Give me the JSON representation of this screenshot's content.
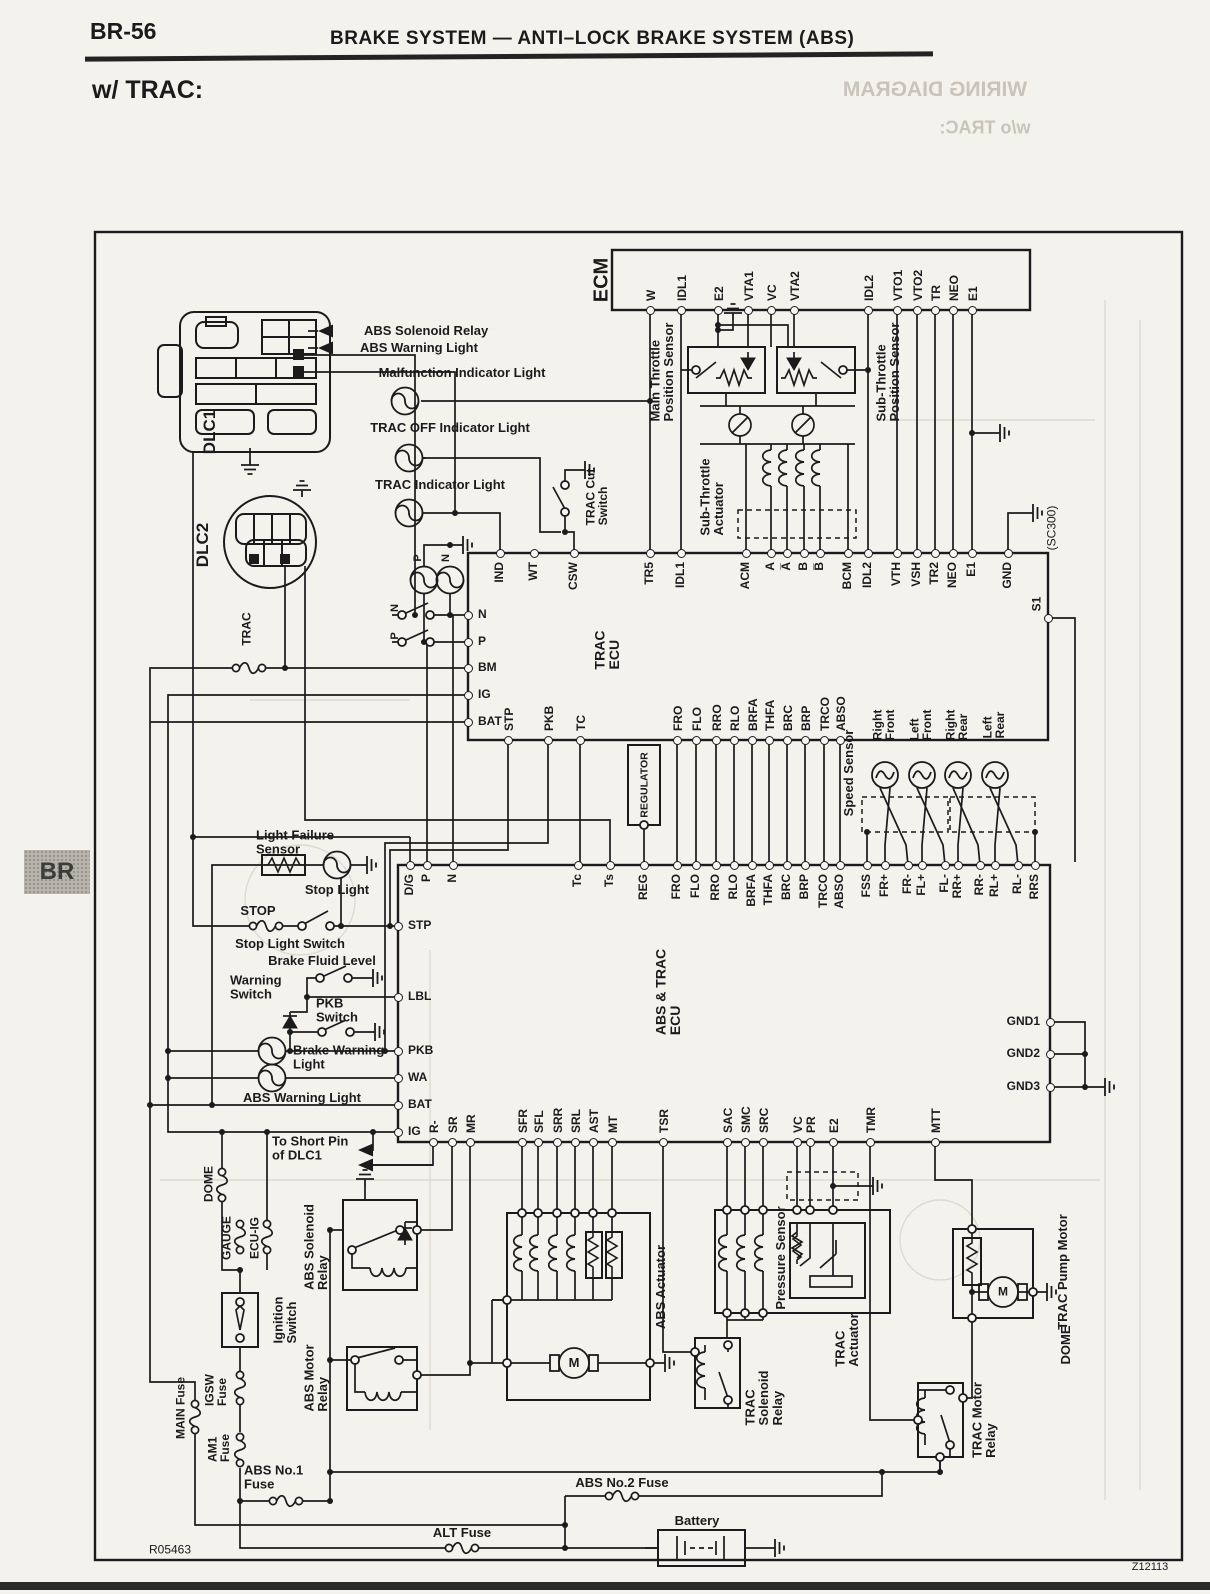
{
  "page": {
    "code": "BR-56",
    "title": "BRAKE SYSTEM — ANTI–LOCK BRAKE SYSTEM (ABS)",
    "subtitle": "w/ TRAC:",
    "side_tab": "BR",
    "doc_number": "R05463",
    "figure_number": "Z12113"
  },
  "ghost_text": [
    {
      "id": "ghost-wiring-diagram",
      "text": "WIRING DIAGRAM",
      "x": 935,
      "y": 90,
      "size": 21,
      "mirror": true
    },
    {
      "id": "ghost-wo-trac",
      "text": "w/o TRAC:",
      "x": 985,
      "y": 128,
      "size": 18,
      "mirror": true
    },
    {
      "id": "ghost-dome",
      "text": "DOME",
      "x": 1066,
      "y": 1345,
      "size": 13,
      "rot": -90
    }
  ],
  "labels": [
    {
      "id": "ecm-title",
      "text": "ECM",
      "x": 602,
      "y": 280,
      "rot": -90,
      "size": 20
    },
    {
      "id": "main-throttle-sensor",
      "text": "Main Throttle\nPosition Sensor",
      "x": 662,
      "y": 372,
      "rot": -90,
      "size": 13
    },
    {
      "id": "sub-throttle-sensor",
      "text": "Sub-Throttle\nPosition Sensor",
      "x": 888,
      "y": 372,
      "rot": -90,
      "size": 13
    },
    {
      "id": "sub-throttle-actuator",
      "text": "Sub-Throttle\nActuator",
      "x": 712,
      "y": 497,
      "rot": -90,
      "size": 13
    },
    {
      "id": "sc300",
      "text": "(SC300)",
      "x": 1052,
      "y": 528,
      "rot": -90,
      "size": 12,
      "bold": false
    },
    {
      "id": "trac-cut-switch",
      "text": "TRAC Cut\nSwitch",
      "x": 597,
      "y": 497,
      "rot": -90,
      "size": 12
    },
    {
      "id": "trac-ecu-title",
      "text": "TRAC\nECU",
      "x": 607,
      "y": 650,
      "rot": -90,
      "size": 14
    },
    {
      "id": "s1-label",
      "text": "S1",
      "x": 1037,
      "y": 604,
      "rot": -90,
      "size": 12
    },
    {
      "id": "malfunction-indicator-light",
      "text": "Malfunction Indicator Light",
      "x": 462,
      "y": 373,
      "size": 13
    },
    {
      "id": "trac-off-indicator-light",
      "text": "TRAC OFF Indicator Light",
      "x": 450,
      "y": 428,
      "size": 13
    },
    {
      "id": "trac-indicator-light",
      "text": "TRAC Indicator Light",
      "x": 440,
      "y": 485,
      "size": 13
    },
    {
      "id": "dlc1",
      "text": "DLC1",
      "x": 210,
      "y": 432,
      "rot": -90,
      "size": 17
    },
    {
      "id": "dlc2",
      "text": "DLC2",
      "x": 203,
      "y": 545,
      "rot": -90,
      "size": 17
    },
    {
      "id": "trac-fuse",
      "text": "TRAC",
      "x": 247,
      "y": 629,
      "rot": -90,
      "size": 12
    },
    {
      "id": "abs-solenoid-relay-callout",
      "text": "ABS Solenoid Relay",
      "x": 404,
      "y": 331,
      "size": 13,
      "align": "left"
    },
    {
      "id": "abs-warning-light-callout",
      "text": "ABS Warning Light",
      "x": 400,
      "y": 348,
      "size": 13,
      "align": "left"
    },
    {
      "id": "p-bulb-label",
      "text": "P",
      "x": 419,
      "y": 558,
      "rot": -90,
      "size": 11
    },
    {
      "id": "n-bulb-label",
      "text": "N",
      "x": 447,
      "y": 558,
      "rot": -90,
      "size": 11
    },
    {
      "id": "n-switch-label",
      "text": "N",
      "x": 396,
      "y": 608,
      "rot": -90,
      "size": 11
    },
    {
      "id": "p-switch-label",
      "text": "P",
      "x": 396,
      "y": 636,
      "rot": -90,
      "size": 11
    },
    {
      "id": "regulator",
      "text": "REGULATOR",
      "x": 645,
      "y": 785,
      "rot": -90,
      "size": 10.5
    },
    {
      "id": "speed-sensor",
      "text": "Speed Sensor",
      "x": 849,
      "y": 773,
      "rot": -90,
      "size": 13
    },
    {
      "id": "speed-rf",
      "text": "Right\nFront",
      "x": 884,
      "y": 725,
      "rot": -90,
      "size": 12
    },
    {
      "id": "speed-lf",
      "text": "Left\nFront",
      "x": 921,
      "y": 725,
      "rot": -90,
      "size": 12
    },
    {
      "id": "speed-rr",
      "text": "Right\nRear",
      "x": 957,
      "y": 725,
      "rot": -90,
      "size": 12
    },
    {
      "id": "speed-lr",
      "text": "Left\nRear",
      "x": 994,
      "y": 725,
      "rot": -90,
      "size": 12
    },
    {
      "id": "abs-trac-ecu-title",
      "text": "ABS & TRAC\nECU",
      "x": 668,
      "y": 992,
      "rot": -90,
      "size": 14
    },
    {
      "id": "light-failure-sensor",
      "text": "Light Failure\nSensor",
      "x": 296,
      "y": 842,
      "size": 13,
      "align": "left"
    },
    {
      "id": "stop-light",
      "text": "Stop Light",
      "x": 337,
      "y": 890,
      "size": 13
    },
    {
      "id": "stop-fuse",
      "text": "STOP",
      "x": 258,
      "y": 911,
      "size": 13
    },
    {
      "id": "stop-light-switch",
      "text": "Stop Light Switch",
      "x": 290,
      "y": 944,
      "size": 13
    },
    {
      "id": "brake-fluid-level",
      "text": "Brake Fluid Level",
      "x": 322,
      "y": 961,
      "size": 13
    },
    {
      "id": "warning-switch",
      "text": "Warning\nSwitch",
      "x": 270,
      "y": 987,
      "size": 13,
      "align": "left"
    },
    {
      "id": "pkb-switch",
      "text": "PKB\nSwitch",
      "x": 356,
      "y": 1010,
      "size": 13,
      "align": "left"
    },
    {
      "id": "brake-warning-light",
      "text": "Brake Warning\nLight",
      "x": 333,
      "y": 1057,
      "size": 13,
      "align": "left"
    },
    {
      "id": "abs-warning-light2",
      "text": "ABS Warning Light",
      "x": 302,
      "y": 1098,
      "size": 13
    },
    {
      "id": "to-short-pin",
      "text": "To Short Pin\nof DLC1",
      "x": 312,
      "y": 1148,
      "size": 13,
      "align": "left"
    },
    {
      "id": "dome-fuse",
      "text": "DOME",
      "x": 209,
      "y": 1184,
      "rot": -90,
      "size": 12
    },
    {
      "id": "gauge-fuse",
      "text": "GAUGE",
      "x": 227,
      "y": 1238,
      "rot": -90,
      "size": 12
    },
    {
      "id": "ecu-ig-fuse",
      "text": "ECU-IG",
      "x": 255,
      "y": 1238,
      "rot": -90,
      "size": 12
    },
    {
      "id": "ignition-switch",
      "text": "Ignition\nSwitch",
      "x": 285,
      "y": 1320,
      "rot": -90,
      "size": 13
    },
    {
      "id": "abs-solenoid-relay",
      "text": "ABS Solenoid\nRelay",
      "x": 316,
      "y": 1247,
      "rot": -90,
      "size": 13
    },
    {
      "id": "abs-motor-relay",
      "text": "ABS Motor\nRelay",
      "x": 316,
      "y": 1378,
      "rot": -90,
      "size": 13
    },
    {
      "id": "main-fuse",
      "text": "MAIN Fuse",
      "x": 181,
      "y": 1408,
      "rot": -90,
      "size": 12
    },
    {
      "id": "igsw-fuse",
      "text": "IGSW\nFuse",
      "x": 216,
      "y": 1390,
      "rot": -90,
      "size": 12
    },
    {
      "id": "am1-fuse",
      "text": "AM1\nFuse",
      "x": 219,
      "y": 1448,
      "rot": -90,
      "size": 12
    },
    {
      "id": "abs-no1-fuse",
      "text": "ABS No.1\nFuse",
      "x": 284,
      "y": 1477,
      "size": 13,
      "align": "left"
    },
    {
      "id": "abs-actuator",
      "text": "ABS Actuator",
      "x": 661,
      "y": 1287,
      "rot": -90,
      "size": 13
    },
    {
      "id": "trac-solenoid-relay",
      "text": "TRAC\nSolenoid\nRelay",
      "x": 764,
      "y": 1398,
      "rot": -90,
      "size": 13
    },
    {
      "id": "pressure-sensor",
      "text": "Pressure Sensor",
      "x": 781,
      "y": 1258,
      "rot": -90,
      "size": 13
    },
    {
      "id": "trac-actuator",
      "text": "TRAC\nActuator",
      "x": 847,
      "y": 1340,
      "rot": -90,
      "size": 13
    },
    {
      "id": "trac-pump-motor",
      "text": "TRAC Pump Motor",
      "x": 1063,
      "y": 1272,
      "rot": -90,
      "size": 13
    },
    {
      "id": "trac-motor-relay",
      "text": "TRAC Motor\nRelay",
      "x": 984,
      "y": 1420,
      "rot": -90,
      "size": 13
    },
    {
      "id": "abs-no2-fuse",
      "text": "ABS No.2 Fuse",
      "x": 622,
      "y": 1483,
      "size": 13
    },
    {
      "id": "alt-fuse",
      "text": "ALT Fuse",
      "x": 462,
      "y": 1533,
      "size": 13
    },
    {
      "id": "battery",
      "text": "Battery",
      "x": 697,
      "y": 1521,
      "size": 13
    },
    {
      "id": "doc-number",
      "text": "R05463",
      "x": 170,
      "y": 1550,
      "size": 12,
      "bold": false
    },
    {
      "id": "fig-number",
      "text": "Z12113",
      "x": 1150,
      "y": 1568,
      "size": 11,
      "bold": false
    },
    {
      "id": "abs-motor-letter",
      "text": "M",
      "x": 574,
      "y": 1363,
      "size": 13
    },
    {
      "id": "trac-motor-letter",
      "text": "M",
      "x": 1003,
      "y": 1292,
      "size": 12
    }
  ],
  "pin_groups": [
    {
      "id": "ecm-pins",
      "dir": "up",
      "y": 310,
      "pins": [
        {
          "name": "W",
          "x": 650
        },
        {
          "name": "IDL1",
          "x": 681
        },
        {
          "name": "E2",
          "x": 718
        },
        {
          "name": "VTA1",
          "x": 748
        },
        {
          "name": "VC",
          "x": 771
        },
        {
          "name": "VTA2",
          "x": 794
        },
        {
          "name": "IDL2",
          "x": 868
        },
        {
          "name": "VTO1",
          "x": 897
        },
        {
          "name": "VTO2",
          "x": 917
        },
        {
          "name": "TR",
          "x": 935
        },
        {
          "name": "NEO",
          "x": 953
        },
        {
          "name": "E1",
          "x": 972
        }
      ]
    },
    {
      "id": "trac-ecu-top",
      "dir": "down",
      "y": 553,
      "pins": [
        {
          "name": "IND",
          "x": 500
        },
        {
          "name": "WT",
          "x": 534
        },
        {
          "name": "CSW",
          "x": 574
        },
        {
          "name": "TR5",
          "x": 650
        },
        {
          "name": "IDL1",
          "x": 681
        },
        {
          "name": "ACM",
          "x": 746
        },
        {
          "name": "A",
          "x": 771
        },
        {
          "name": "A̅",
          "x": 787
        },
        {
          "name": "B",
          "x": 804
        },
        {
          "name": "B̅",
          "x": 820
        },
        {
          "name": "BCM",
          "x": 848
        },
        {
          "name": "IDL2",
          "x": 868
        },
        {
          "name": "VTH",
          "x": 897
        },
        {
          "name": "VSH",
          "x": 917
        },
        {
          "name": "TR2",
          "x": 935
        },
        {
          "name": "NEO",
          "x": 953
        },
        {
          "name": "E1",
          "x": 972
        },
        {
          "name": "GND",
          "x": 1008
        }
      ]
    },
    {
      "id": "trac-ecu-left",
      "dir": "right",
      "x": 468,
      "pins": [
        {
          "name": "N",
          "y": 615
        },
        {
          "name": "P",
          "y": 642
        },
        {
          "name": "BM",
          "y": 668
        },
        {
          "name": "IG",
          "y": 695
        },
        {
          "name": "BAT",
          "y": 722
        }
      ]
    },
    {
      "id": "trac-ecu-right",
      "dir": "single",
      "pins": [
        {
          "name": "S1",
          "x": 1048,
          "y": 618
        }
      ]
    },
    {
      "id": "trac-ecu-bottom",
      "dir": "up",
      "y": 740,
      "pins": [
        {
          "name": "STP",
          "x": 508
        },
        {
          "name": "PKB",
          "x": 548
        },
        {
          "name": "TC",
          "x": 580
        },
        {
          "name": "FRO",
          "x": 677
        },
        {
          "name": "FLO",
          "x": 696
        },
        {
          "name": "RRO",
          "x": 716
        },
        {
          "name": "RLO",
          "x": 734
        },
        {
          "name": "BRFA",
          "x": 752
        },
        {
          "name": "THFA",
          "x": 769
        },
        {
          "name": "BRC",
          "x": 787
        },
        {
          "name": "BRP",
          "x": 805
        },
        {
          "name": "TRCO",
          "x": 824
        },
        {
          "name": "ABSO",
          "x": 840
        }
      ]
    },
    {
      "id": "abs-trac-ecu-top",
      "dir": "down",
      "y": 865,
      "pins": [
        {
          "name": "D/G",
          "x": 410
        },
        {
          "name": "P",
          "x": 427
        },
        {
          "name": "N",
          "x": 453
        },
        {
          "name": "Tc",
          "x": 578
        },
        {
          "name": "Ts",
          "x": 610
        },
        {
          "name": "REG",
          "x": 644
        },
        {
          "name": "FRO",
          "x": 677
        },
        {
          "name": "FLO",
          "x": 696
        },
        {
          "name": "RRO",
          "x": 716
        },
        {
          "name": "RLO",
          "x": 734
        },
        {
          "name": "BRFA",
          "x": 752
        },
        {
          "name": "THFA",
          "x": 769
        },
        {
          "name": "BRC",
          "x": 787
        },
        {
          "name": "BRP",
          "x": 805
        },
        {
          "name": "TRCO",
          "x": 824
        },
        {
          "name": "ABSO",
          "x": 840
        },
        {
          "name": "FSS",
          "x": 867
        },
        {
          "name": "FR+",
          "x": 885
        },
        {
          "name": "FR-",
          "x": 908
        },
        {
          "name": "FL+",
          "x": 922
        },
        {
          "name": "FL-",
          "x": 945
        },
        {
          "name": "RR+",
          "x": 958
        },
        {
          "name": "RR-",
          "x": 980
        },
        {
          "name": "RL+",
          "x": 995
        },
        {
          "name": "RL-",
          "x": 1018
        },
        {
          "name": "RRS",
          "x": 1035
        }
      ]
    },
    {
      "id": "abs-trac-ecu-left",
      "dir": "right",
      "x": 398,
      "pins": [
        {
          "name": "STP",
          "y": 926
        },
        {
          "name": "LBL",
          "y": 997
        },
        {
          "name": "PKB",
          "y": 1051
        },
        {
          "name": "WA",
          "y": 1078
        },
        {
          "name": "BAT",
          "y": 1105
        },
        {
          "name": "IG",
          "y": 1132
        }
      ]
    },
    {
      "id": "abs-trac-ecu-right",
      "dir": "left",
      "x": 1050,
      "pins": [
        {
          "name": "GND1",
          "y": 1022
        },
        {
          "name": "GND2",
          "y": 1054
        },
        {
          "name": "GND3",
          "y": 1087
        }
      ]
    },
    {
      "id": "abs-trac-ecu-bottom",
      "dir": "up",
      "y": 1142,
      "pins": [
        {
          "name": "R-",
          "x": 433
        },
        {
          "name": "SR",
          "x": 452
        },
        {
          "name": "MR",
          "x": 470
        },
        {
          "name": "SFR",
          "x": 522
        },
        {
          "name": "SFL",
          "x": 538
        },
        {
          "name": "SRR",
          "x": 557
        },
        {
          "name": "SRL",
          "x": 575
        },
        {
          "name": "AST",
          "x": 593
        },
        {
          "name": "MT",
          "x": 612
        },
        {
          "name": "TSR",
          "x": 663
        },
        {
          "name": "SAC",
          "x": 727
        },
        {
          "name": "SMC",
          "x": 745
        },
        {
          "name": "SRC",
          "x": 763
        },
        {
          "name": "VC",
          "x": 797
        },
        {
          "name": "PR",
          "x": 810
        },
        {
          "name": "E2",
          "x": 833
        },
        {
          "name": "TMR",
          "x": 870
        },
        {
          "name": "MTT",
          "x": 935
        }
      ]
    }
  ]
}
